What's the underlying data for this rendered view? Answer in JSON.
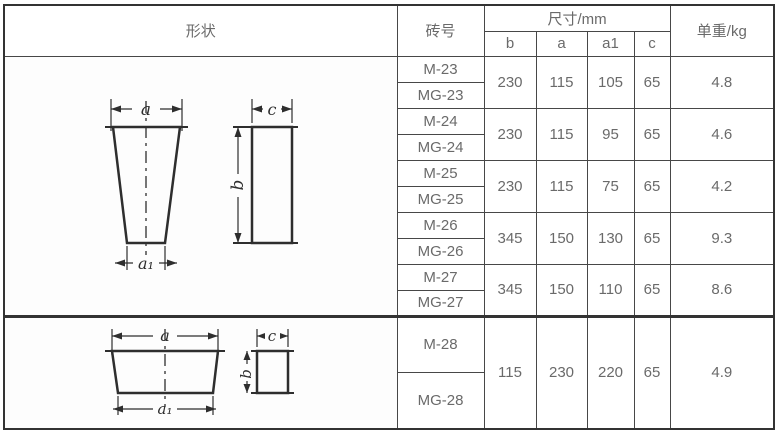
{
  "page": {
    "background": "#ffffff",
    "border_color": "#333333",
    "text_color": "#6a6a6a"
  },
  "table": {
    "headers": {
      "shape": "形状",
      "brick_no": "砖号",
      "dimensions": "尺寸/mm",
      "dim_cols": [
        "b",
        "a",
        "a1",
        "c"
      ],
      "unit_weight": "单重/kg"
    },
    "sections": [
      {
        "shape": "tall-tapered-wedge-brick-front-and-side-view",
        "labels": {
          "a": "a",
          "a1": "a₁",
          "b": "b",
          "c": "c"
        },
        "groups": [
          {
            "bricks": [
              "M-23",
              "MG-23"
            ],
            "b": "230",
            "a": "115",
            "a1": "105",
            "c": "65",
            "weight": "4.8"
          },
          {
            "bricks": [
              "M-24",
              "MG-24"
            ],
            "b": "230",
            "a": "115",
            "a1": "95",
            "c": "65",
            "weight": "4.6"
          },
          {
            "bricks": [
              "M-25",
              "MG-25"
            ],
            "b": "230",
            "a": "115",
            "a1": "75",
            "c": "65",
            "weight": "4.2"
          },
          {
            "bricks": [
              "M-26",
              "MG-26"
            ],
            "b": "345",
            "a": "150",
            "a1": "130",
            "c": "65",
            "weight": "9.3"
          },
          {
            "bricks": [
              "M-27",
              "MG-27"
            ],
            "b": "345",
            "a": "150",
            "a1": "110",
            "c": "65",
            "weight": "8.6"
          }
        ]
      },
      {
        "shape": "flat-wedge-brick-front-and-side-view",
        "labels": {
          "a": "a",
          "a1": "a₁",
          "b": "b",
          "c": "c"
        },
        "groups": [
          {
            "bricks": [
              "M-28",
              "MG-28"
            ],
            "b": "115",
            "a": "230",
            "a1": "220",
            "c": "65",
            "weight": "4.9"
          }
        ]
      }
    ]
  }
}
